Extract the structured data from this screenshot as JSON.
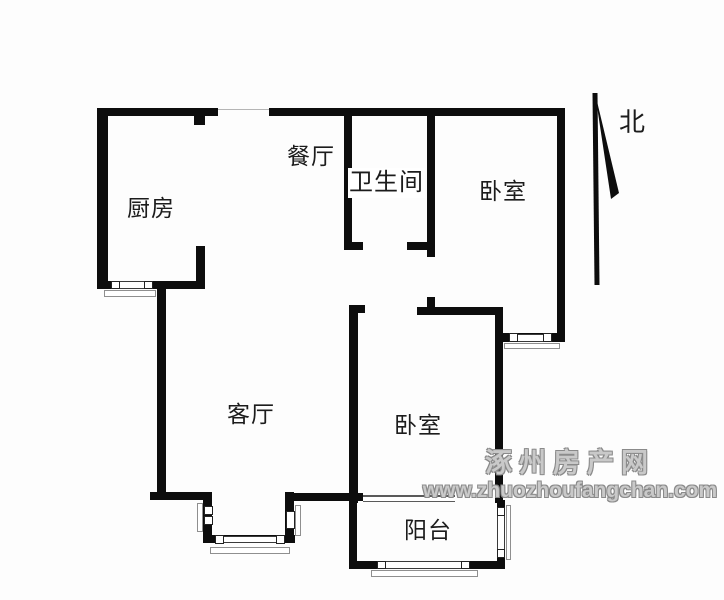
{
  "rooms": {
    "kitchen": {
      "label": "厨房"
    },
    "dining": {
      "label": "餐厅"
    },
    "bathroom": {
      "label": "卫生间"
    },
    "bedroom_north": {
      "label": "卧室"
    },
    "living_room": {
      "label": "客厅"
    },
    "bedroom_south": {
      "label": "卧室"
    },
    "balcony": {
      "label": "阳台"
    }
  },
  "compass": {
    "label": "北"
  },
  "watermark": {
    "site_name": "涿州房产网",
    "site_url": "www.zhuozhoufangchan.com"
  },
  "colors": {
    "wall": "#0d0d0d",
    "background": "#fdfdfd",
    "watermark_gray": "#9a9a9a"
  }
}
